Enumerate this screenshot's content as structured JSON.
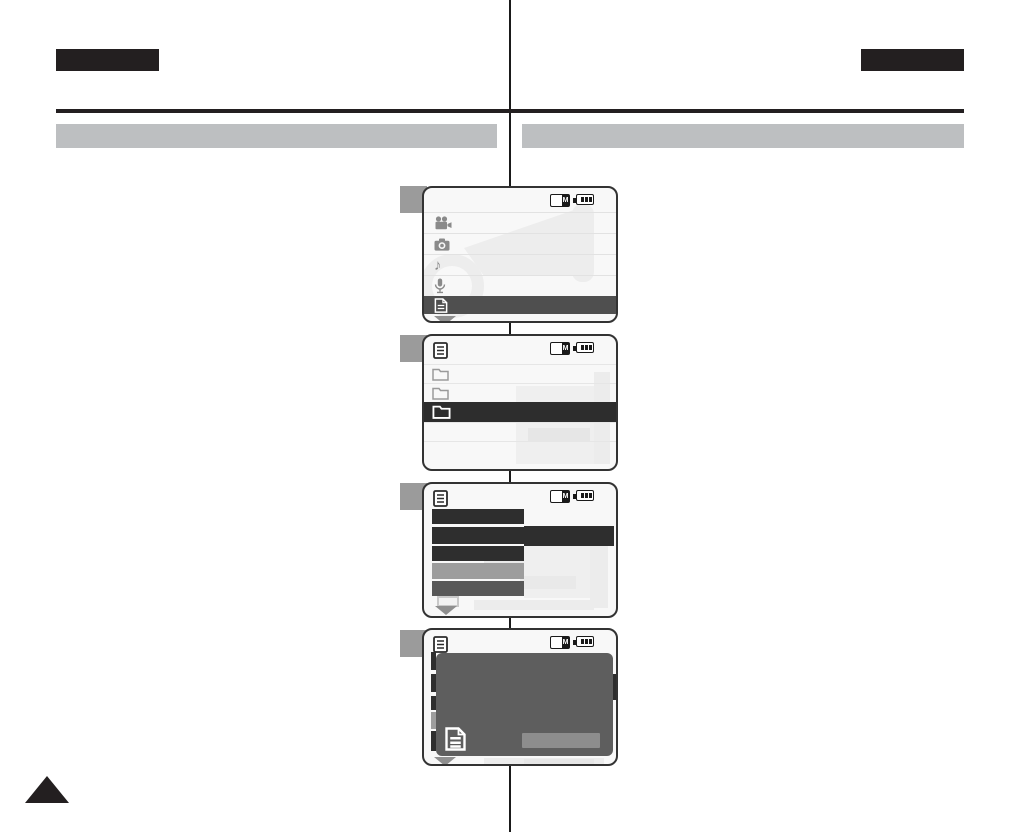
{
  "header": {
    "left_language_tab_text": "",
    "right_language_tab_text": "",
    "left_section_title": "",
    "right_section_title": ""
  },
  "lcd": {
    "memory_card_letter": "M",
    "battery_level": "full"
  },
  "icons": {
    "music_note_glyph": "♪"
  },
  "steps": [
    {
      "badge_text": "",
      "screen": "main-menu",
      "status_icons": [
        "memory-card-icon",
        "battery-icon"
      ],
      "menu_rows": [
        {
          "icon": "movie-camera-icon",
          "selected": false
        },
        {
          "icon": "photo-camera-icon",
          "selected": false
        },
        {
          "icon": "music-note-icon",
          "selected": false
        },
        {
          "icon": "microphone-icon",
          "selected": false
        },
        {
          "icon": "file-document-icon",
          "selected": true
        }
      ],
      "scroll_down_indicator": true
    },
    {
      "badge_text": "",
      "screen": "folder-list",
      "title_icon": "file-list-icon",
      "status_icons": [
        "memory-card-icon",
        "battery-icon"
      ],
      "rows": [
        {
          "icon": "folder-icon",
          "selected": false
        },
        {
          "icon": "folder-icon",
          "selected": false
        },
        {
          "icon": "folder-icon",
          "selected": true
        },
        {
          "icon": null,
          "selected": false
        },
        {
          "icon": null,
          "selected": false
        }
      ]
    },
    {
      "badge_text": "",
      "screen": "settings-options",
      "title_icon": "file-list-icon",
      "status_icons": [
        "memory-card-icon",
        "battery-icon"
      ],
      "option_bars": [
        {
          "tone": "dark",
          "has_value_bar": false
        },
        {
          "tone": "dark",
          "has_value_bar": true
        },
        {
          "tone": "dark",
          "has_value_bar": false
        },
        {
          "tone": "gray",
          "has_value_bar": false
        },
        {
          "tone": "mid",
          "has_value_bar": false
        }
      ],
      "scroll_down_indicator": true
    },
    {
      "badge_text": "",
      "screen": "confirmation-popup",
      "title_icon": "file-list-icon",
      "status_icons": [
        "memory-card-icon",
        "battery-icon"
      ],
      "popup": {
        "icon": "file-document-icon",
        "button_label": ""
      },
      "scroll_down_indicator": true
    }
  ],
  "colors": {
    "header_block": "#231f20",
    "section_bar": "#bdbfc1",
    "badge": "#9b9b9b",
    "screen_border": "#333333",
    "selected_row_screen1": "#4f4f4f",
    "selected_row_screen2": "#2d2d2d",
    "option_bar_dark": "#2e2e2e",
    "option_bar_gray": "#9d9d9d",
    "option_bar_mid": "#585858",
    "popup_overlay": "#5e5e5e",
    "popup_button": "#8d8d8d",
    "icon_gray": "#8a8a8a",
    "watermark": "#ededed"
  }
}
